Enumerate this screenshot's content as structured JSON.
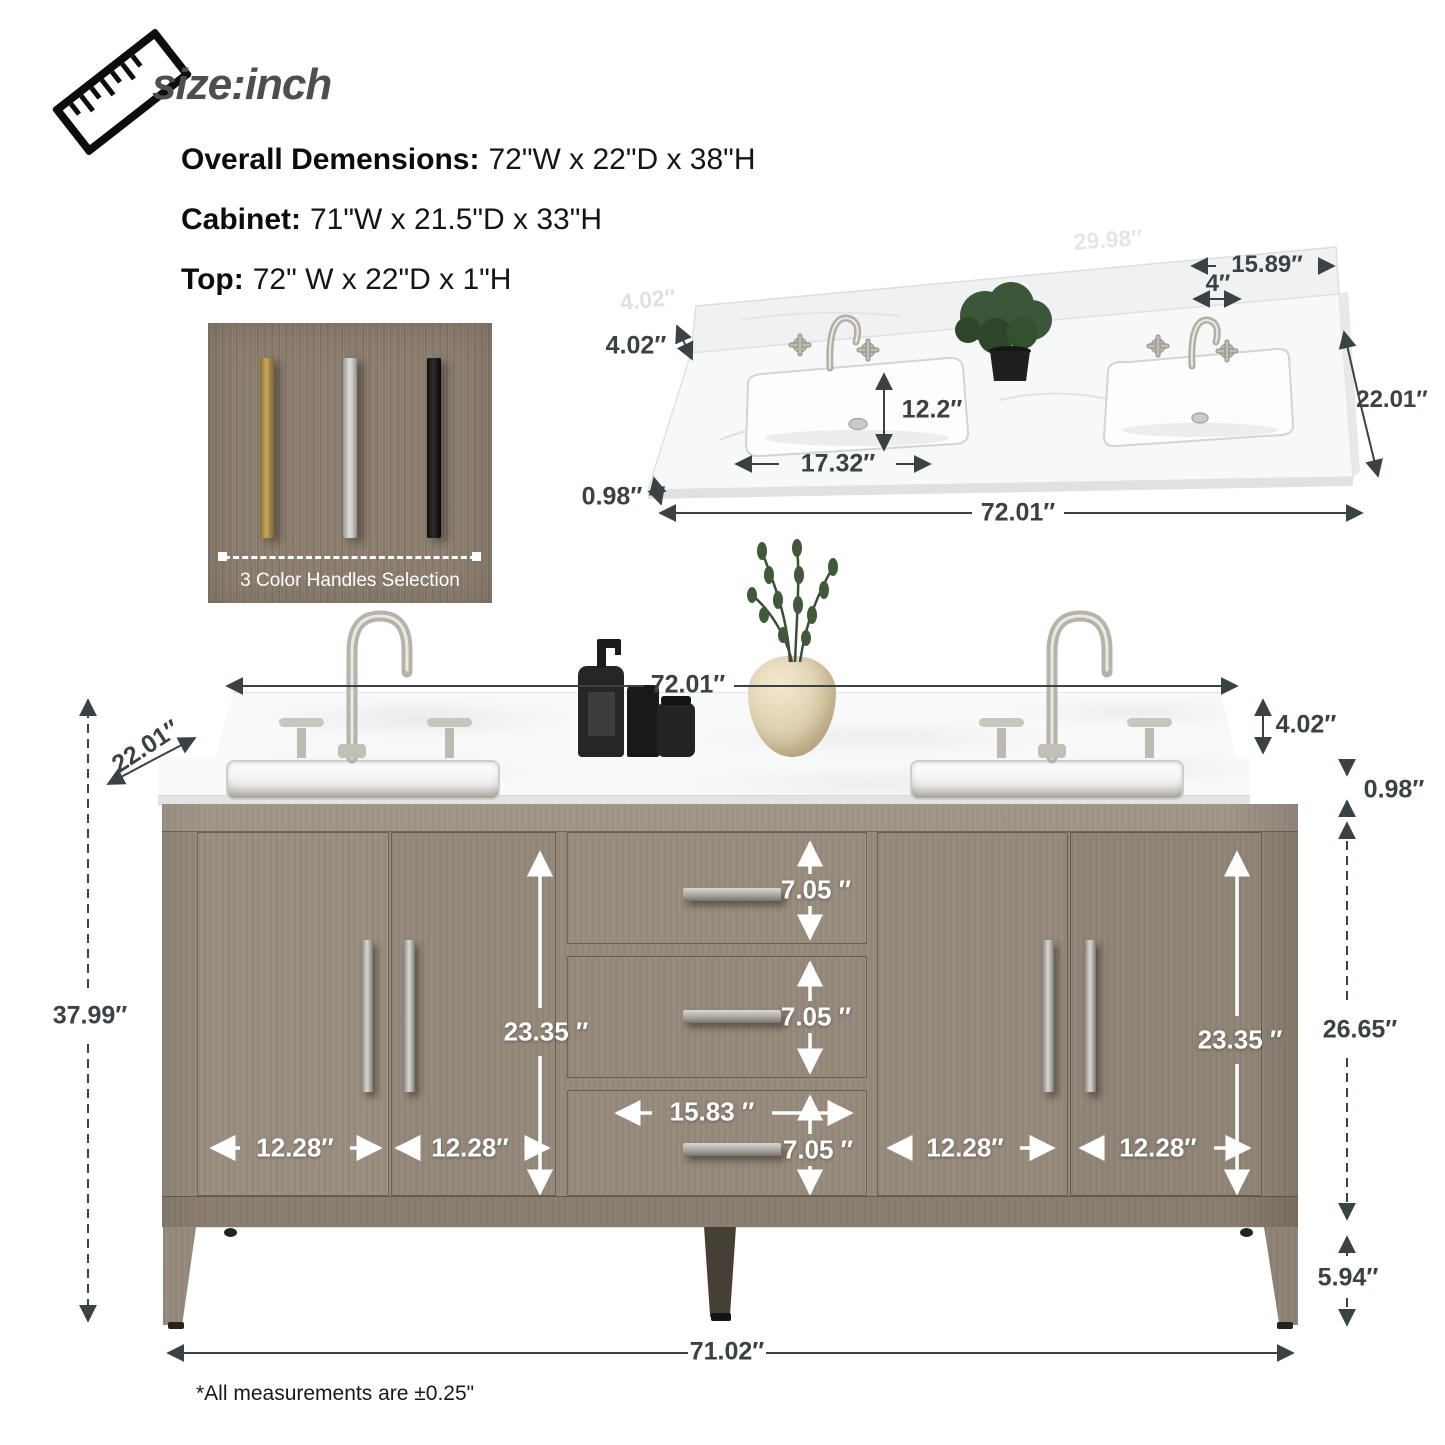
{
  "header": {
    "size_label": "size:inch",
    "specs": [
      {
        "label": "Overall Demensions:",
        "value": "72\"W x 22\"D x 38\"H"
      },
      {
        "label": "Cabinet:",
        "value": "71\"W x 21.5\"D x 33\"H"
      },
      {
        "label": "Top:",
        "value": "72\" W x 22\"D x 1\"H"
      }
    ]
  },
  "handle_selection": {
    "caption": "3 Color Handles Selection",
    "options": [
      {
        "name": "gold",
        "color": "#b2914e"
      },
      {
        "name": "silver",
        "color": "#c9c8c4"
      },
      {
        "name": "black",
        "color": "#1a1a1a"
      }
    ]
  },
  "countertop_diagram": {
    "backsplash_height": "4.02″",
    "sink_depth": "12.2″",
    "sink_width": "17.32″",
    "top_thickness": "0.98″",
    "total_width": "72.01″",
    "right_sink_width": "15.89″",
    "faucet_hole_spacing": "4″",
    "depth": "22.01″",
    "watermark_1": "4.02″",
    "watermark_2": "29.98″"
  },
  "vanity_diagram": {
    "top_width": "72.01″",
    "top_depth": "22.01″",
    "backsplash_height": "4.02″",
    "top_thickness": "0.98″",
    "overall_height": "37.99″",
    "cabinet_height": "26.65″",
    "leg_height": "5.94″",
    "base_width": "71.02″",
    "door_height_left": "23.35 ″",
    "door_height_right": "23.35 ″",
    "drawer_height_1": "7.05 ″",
    "drawer_height_2": "7.05 ″",
    "drawer_height_3": "7.05 ″",
    "drawer_width": "15.83 ″",
    "door_width_1": "12.28″",
    "door_width_2": "12.28″",
    "door_width_3": "12.28″",
    "door_width_4": "12.28″"
  },
  "footnote": "*All measurements are ±0.25\""
}
